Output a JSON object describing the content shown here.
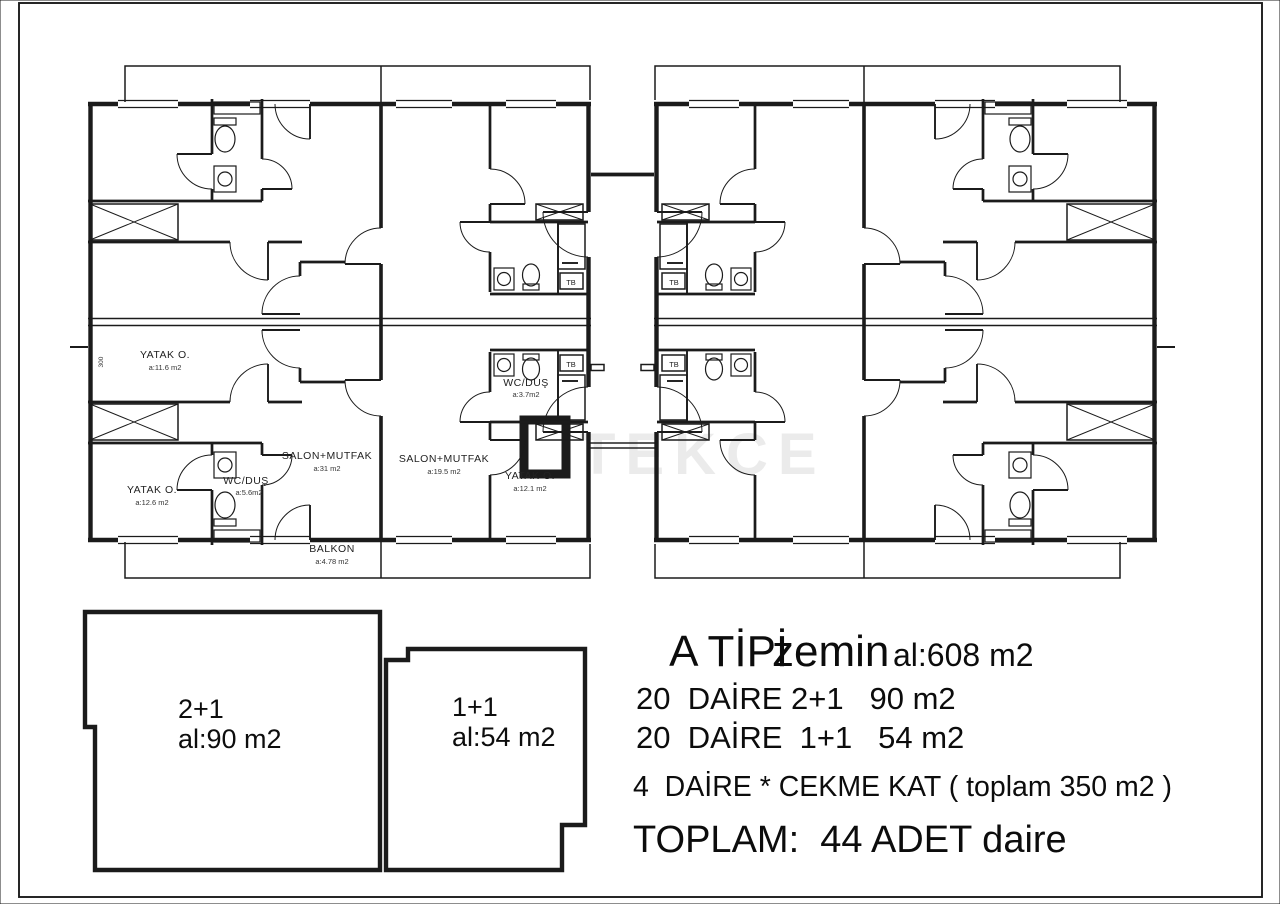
{
  "sheet": {
    "background": "#ffffff",
    "line_color": "#1b1b1b"
  },
  "watermark": "TEKCE",
  "plan": {
    "closet_label": "TB",
    "dimension": "300",
    "rooms": [
      {
        "name": "YATAK O.",
        "area": "a:11.6 m2"
      },
      {
        "name": "YATAK O.",
        "area": "a:12.6 m2"
      },
      {
        "name": "WC/DUŞ",
        "area": "a:5.6m2"
      },
      {
        "name": "SALON+MUTFAK",
        "area": "a:31 m2"
      },
      {
        "name": "SALON+MUTFAK",
        "area": "a:19.5 m2"
      },
      {
        "name": "WC/DUŞ",
        "area": "a:3.7m2"
      },
      {
        "name": "YATAK O.",
        "area": "a:12.1 m2"
      },
      {
        "name": "BALKON",
        "area": "a:4.78 m2"
      }
    ]
  },
  "units": {
    "u21": {
      "type": "2+1",
      "area": "al:90 m2"
    },
    "u11": {
      "type": "1+1",
      "area": "al:54 m2"
    }
  },
  "summary": {
    "title": "A TİPİ",
    "floor": "zemin",
    "total_area": "al:608 m2",
    "line_2plus1": "20  DAİRE 2+1   90 m2",
    "line_1plus1": "20  DAİRE  1+1   54 m2",
    "line_penthouse": "4  DAİRE * CEKME KAT ( toplam 350 m2 )",
    "total": "TOPLAM:  44 ADET daire"
  }
}
